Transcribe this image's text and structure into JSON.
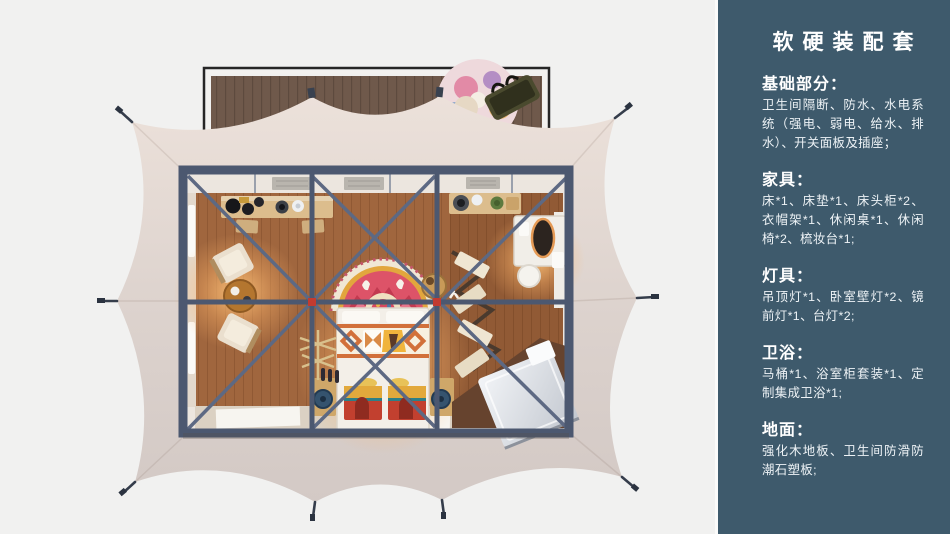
{
  "sidebar": {
    "title": "软硬装配套",
    "bg_color": "#3e5a6c",
    "text_color": "#ffffff",
    "sections": [
      {
        "id": "basics",
        "title": "基础部分：",
        "body": "卫生间隔断、防水、水电系统（强电、弱电、给水、排水）、开关面板及插座；"
      },
      {
        "id": "furniture",
        "title": "家具：",
        "body": "床*1、床垫*1、床头柜*2、衣帽架*1、休闲桌*1、休闲椅*2、梳妆台*1;"
      },
      {
        "id": "lighting",
        "title": "灯具：",
        "body": "吊顶灯*1、卧室壁灯*2、镜前灯*1、台灯*2;"
      },
      {
        "id": "bath",
        "title": "卫浴：",
        "body": "马桶*1、浴室柜套装*1、定制集成卫浴*1;"
      },
      {
        "id": "floor",
        "title": "地面：",
        "body": "强化木地板、卫生间防滑防潮石塑板;"
      }
    ]
  },
  "scene": {
    "palette": {
      "background": "#f1f1f0",
      "tent_canvas": "#ddd2cc",
      "deck_wood": "#6f594b",
      "deck_frame": "#262626",
      "room_floor": "#a0663e",
      "steel_frame": "#4c5870",
      "joint_accent": "#c23b30",
      "lamp_glow": "#ffb469",
      "bed_linen": "#f3efe8",
      "arch_rug_red": "#dd5368",
      "chest_red": "#c2402f",
      "chest_gold": "#e2a93c",
      "bathroom_unit": "#dfe3e8"
    }
  }
}
